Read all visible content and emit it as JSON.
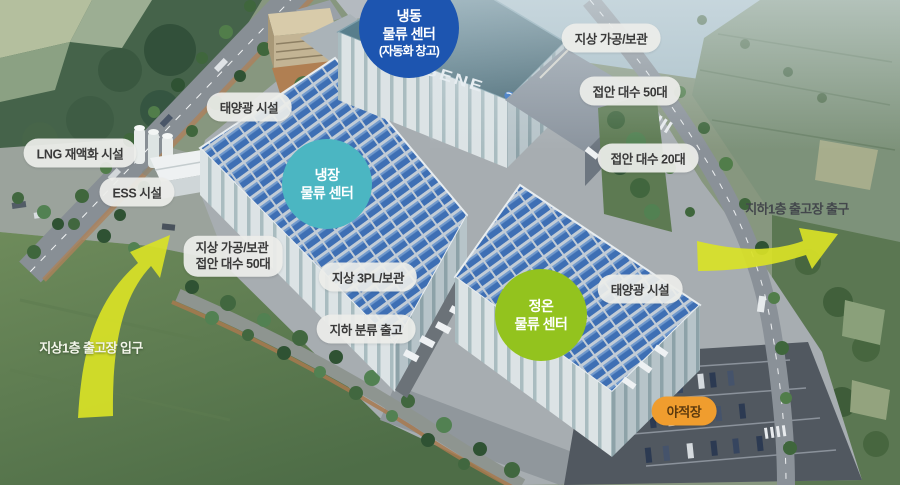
{
  "scene": {
    "description": "물류 센터 단지 조감도",
    "brand_logo": "EUGENE"
  },
  "centers": {
    "frozen": {
      "line1": "냉동",
      "line2": "물류 센터",
      "line3": "(자동화 창고)",
      "color": "#1d55b0"
    },
    "cold": {
      "line1": "냉장",
      "line2": "물류 센터",
      "color": "#4bb6c2"
    },
    "ambient": {
      "line1": "정온",
      "line2": "물류 센터",
      "color": "#93c31e"
    }
  },
  "facility_labels": {
    "solar_nw": "태양광 시설",
    "lng": "LNG 재액화 시설",
    "ess": "ESS 시설",
    "processing_storage_ne": "지상 가공/보관",
    "berth_50_ne": "접안 대수 50대",
    "berth_20_e": "접안 대수 20대",
    "processing_storage_w_line1": "지상 가공/보관",
    "processing_storage_w_line2": "접안 대수 50대",
    "ground_3pl": "지상 3PL/보관",
    "underground_sorting": "지하 분류 출고",
    "solar_se": "태양광 시설",
    "yard": "야적장"
  },
  "flow_labels": {
    "exit_b1": "지하1층 출고장 출구",
    "entrance_1f": "지상1층 출고장 입구"
  },
  "colors": {
    "label_pill": "#edeeea",
    "yard_pill": "#f09d2e",
    "arrow": "#d9e226",
    "solar_panel": "#3e6fb4"
  }
}
